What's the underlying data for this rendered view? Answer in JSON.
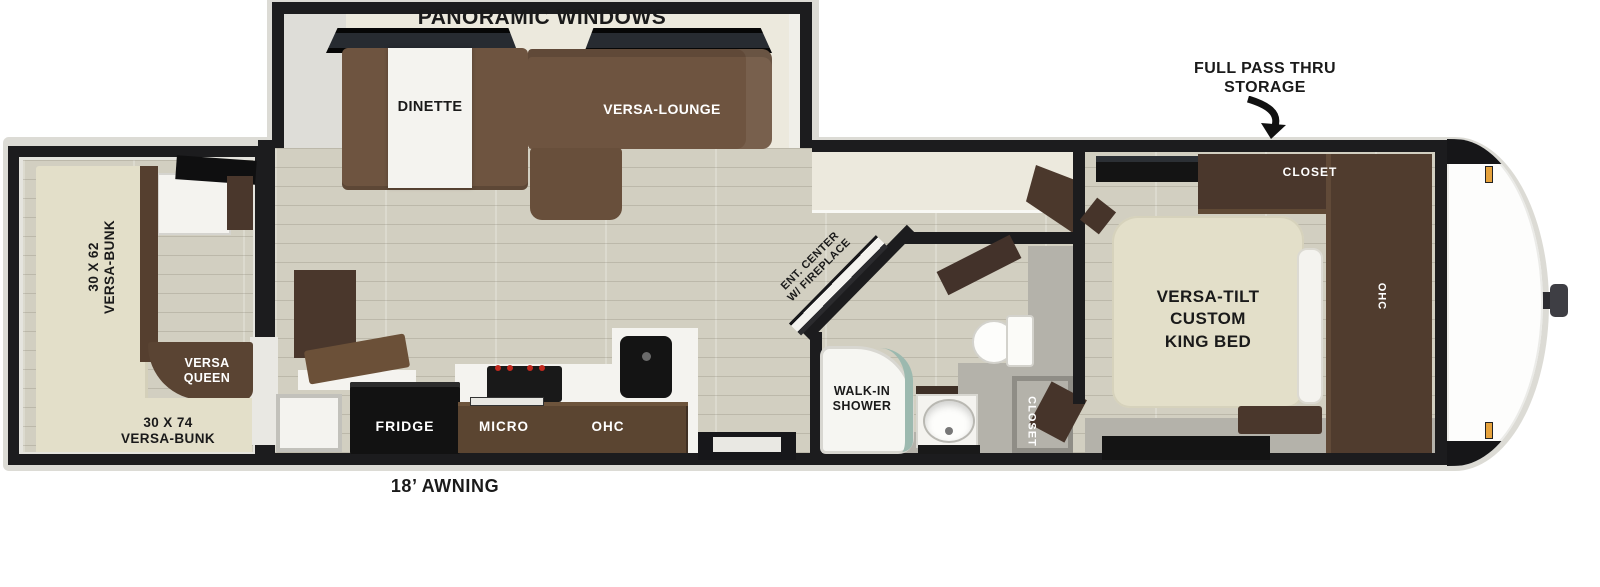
{
  "exterior": {
    "panoramic_windows": "PANORAMIC WINDOWS",
    "pass_thru_line1": "FULL PASS THRU",
    "pass_thru_line2": "STORAGE",
    "awning": "18’ AWNING"
  },
  "slideout": {
    "dinette": "DINETTE",
    "lounge": "VERSA-LOUNGE"
  },
  "bunk_room": {
    "bunk_62_line1": "30 X 62",
    "bunk_62_line2": "VERSA-BUNK",
    "queen_line1": "VERSA",
    "queen_line2": "QUEEN",
    "bunk_74_line1": "30 X 74",
    "bunk_74_line2": "VERSA-BUNK"
  },
  "kitchen": {
    "fridge": "FRIDGE",
    "micro": "MICRO",
    "ohc": "OHC"
  },
  "living": {
    "ent_line1": "ENT. CENTER",
    "ent_line2": "W/ FIREPLACE"
  },
  "bathroom": {
    "shower_line1": "WALK-IN",
    "shower_line2": "SHOWER",
    "closet": "CLOSET"
  },
  "bedroom": {
    "bed_line1": "VERSA-TILT",
    "bed_line2": "CUSTOM",
    "bed_line3": "KING BED",
    "closet": "CLOSET",
    "ohc": "OHC"
  },
  "icons": {
    "storage_arrow": "curved-down-arrow"
  },
  "colors": {
    "wall": "#1c1c1e",
    "floor": "#d2cfc1",
    "slide_wall_cream": "#ece9dd",
    "sofa_brown": "#6e5440",
    "cabinet_dark_brown": "#4a372c",
    "bed_beige": "#e3dfc9",
    "shower_glass_teal": "#9cb9af",
    "marker_amber": "#e6a23c",
    "stove_knob_red": "#c2291e",
    "gray_floor": "#b4b2aa"
  }
}
